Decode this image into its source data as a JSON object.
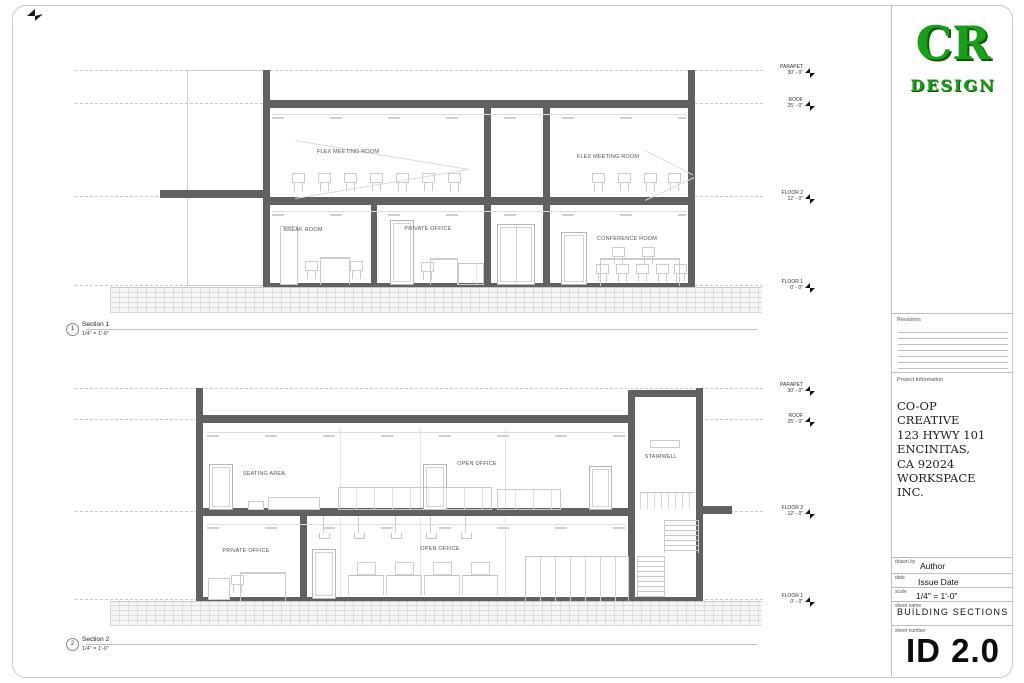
{
  "logo": {
    "initials": "CR",
    "subtitle": "DESIGN",
    "color": "#18a018"
  },
  "title_block": {
    "revisions_label": "Revisions",
    "project_information_label": "Project Information",
    "project_lines": [
      "CO-OP",
      "CREATIVE",
      "123 HYWY 101",
      "ENCINITAS,",
      "CA 92024",
      "WORKSPACE",
      "INC."
    ],
    "drawn_by_label": "drawn by",
    "drawn_by_value": "Author",
    "date_label": "date",
    "date_value": "Issue Date",
    "scale_label": "scale",
    "scale_value": "1/4\" = 1'-0\"",
    "sheet_name_label": "sheet name",
    "sheet_name_value": "BUILDING SECTIONS",
    "sheet_number_label": "sheet number",
    "sheet_number_value": "ID 2.0"
  },
  "sections": [
    {
      "number": "1",
      "title": "Section 1",
      "scale": "1/4\" = 1'-0\"",
      "levels": [
        {
          "name": "PARAPET",
          "elevation": "30' - 0\""
        },
        {
          "name": "ROOF",
          "elevation": "25' - 0\""
        },
        {
          "name": "FLOOR 2",
          "elevation": "12' - 0\""
        },
        {
          "name": "FLOOR 1",
          "elevation": "0' - 0\""
        }
      ],
      "rooms": [
        {
          "label": "FLEX MEETING ROOM"
        },
        {
          "label": "FLEX MEETING ROOM"
        },
        {
          "label": "BREAK ROOM"
        },
        {
          "label": "PRIVATE OFFICE"
        },
        {
          "label": "CONFERENCE ROOM"
        }
      ]
    },
    {
      "number": "2",
      "title": "Section 2",
      "scale": "1/4\" = 1'-0\"",
      "levels": [
        {
          "name": "PARAPET",
          "elevation": "30' - 0\""
        },
        {
          "name": "ROOF",
          "elevation": "25' - 0\""
        },
        {
          "name": "FLOOR 2",
          "elevation": "12' - 0\""
        },
        {
          "name": "FLOOR 1",
          "elevation": "0' - 0\""
        }
      ],
      "rooms": [
        {
          "label": "SEATING AREA"
        },
        {
          "label": "OPEN OFFICE"
        },
        {
          "label": "STAIRWELL"
        },
        {
          "label": "PRIVATE OFFICE"
        },
        {
          "label": "OPEN OFFICE"
        }
      ]
    }
  ]
}
